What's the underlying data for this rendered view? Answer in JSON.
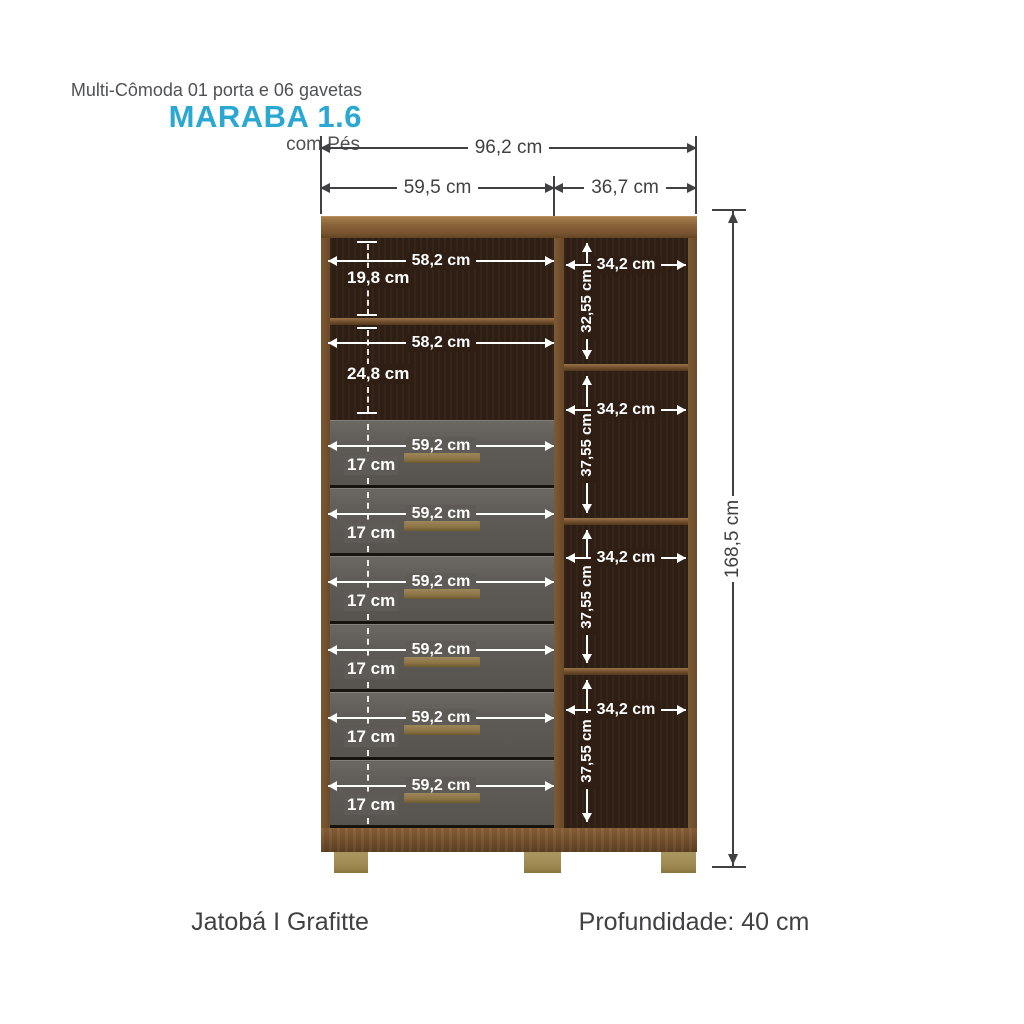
{
  "header": {
    "subtitle": "Multi-Cômoda 01 porta e 06 gavetas",
    "title": "MARABA 1.6",
    "variant": "com Pés"
  },
  "overall_dimensions": {
    "total_width": "96,2 cm",
    "left_section_width": "59,5 cm",
    "right_section_width": "36,7 cm",
    "total_height": "168,5 cm"
  },
  "left_shelves": [
    {
      "width": "58,2 cm",
      "height": "19,8 cm"
    },
    {
      "width": "58,2 cm",
      "height": "24,8 cm"
    }
  ],
  "drawers": [
    {
      "width": "59,2 cm",
      "height": "17 cm"
    },
    {
      "width": "59,2 cm",
      "height": "17 cm"
    },
    {
      "width": "59,2 cm",
      "height": "17 cm"
    },
    {
      "width": "59,2 cm",
      "height": "17 cm"
    },
    {
      "width": "59,2 cm",
      "height": "17 cm"
    },
    {
      "width": "59,2 cm",
      "height": "17 cm"
    }
  ],
  "right_shelves": [
    {
      "width": "34,2 cm",
      "height": "32,55 cm"
    },
    {
      "width": "34,2 cm",
      "height": "37,55 cm"
    },
    {
      "width": "34,2 cm",
      "height": "37,55 cm"
    },
    {
      "width": "34,2 cm",
      "height": "37,55 cm"
    }
  ],
  "footer": {
    "finish": "Jatobá I Grafitte",
    "depth": "Profundidade: 40 cm"
  },
  "colors": {
    "accent": "#2AA8D2",
    "dimension_text": "#414042",
    "frame_wood": "#7A5430",
    "interior_wood": "#2E1E13",
    "drawer_front": "#5E5A55",
    "handle": "#8A7446",
    "feet": "#9D8850",
    "interior_dimension": "#FFFFFF"
  }
}
